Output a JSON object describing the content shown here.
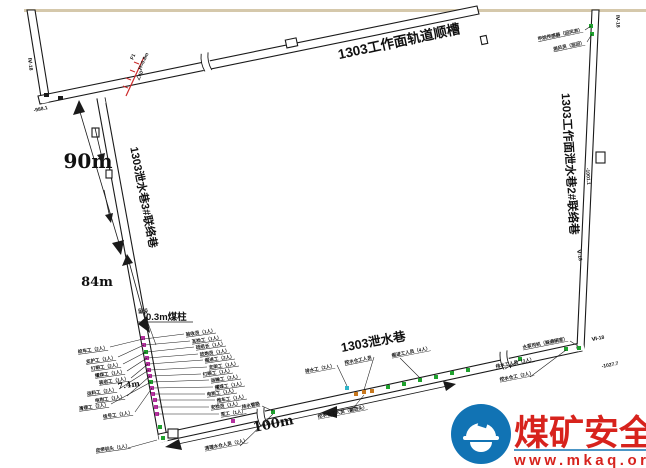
{
  "meta": {
    "bg": "#ffffff",
    "top_border_color": "#d5c8ab"
  },
  "tunnels": {
    "track_gateway": "1303工作面轨道顺槽",
    "left_branch": "1303泄水巷3#联络巷",
    "right_branch": "1303工作面泄水巷2#联络巷",
    "drain_gateway": "1303泄水巷"
  },
  "dimensions": {
    "left_upper": "90m",
    "left_lower": "84m",
    "bottom": "100m",
    "small": "7.4m",
    "pillar_prefix": "留设",
    "pillar": "0.3m煤柱"
  },
  "survey_points": {
    "nw": "Ⅳ-18",
    "nw_elev": "-988.1",
    "ne": "Ⅳ-18",
    "east": "Ⅴ-18",
    "east_elev": "-1001.1",
    "se": "Ⅵ-18",
    "se_elev": "-1027.7"
  },
  "fault": {
    "name": "F1",
    "throw": "H=0.8m",
    "dip": "∠40°",
    "color": "#cc2a2a"
  },
  "workers": {
    "left": [
      "绞车工（2人）",
      "支护工（1人）",
      "打眼工（2人）",
      "攉煤工（1人）",
      "装岩工（1人）",
      "运料工（2人）",
      "电钳工（1人）",
      "清理工（2人）",
      "信号工（1人）"
    ],
    "right": [
      "验收员（1人）",
      "瓦检工（1人）",
      "班组长（1人）",
      "放炮员（1人）",
      "掘进工（2人）",
      "支架工（1人）",
      "打眼工（1人）",
      "运输工（2人）",
      "攉煤工（1人）",
      "电钳工（1人）",
      "推车工（1人）",
      "安检员（1人）",
      "泵工（1人）"
    ],
    "corner_below": [
      "皮带机头（1人）"
    ],
    "bottom_above": [
      "排水工（2人）",
      "挖水仓工人员",
      "掘进工人员（4人）",
      "排水工人员（3人）",
      "水泵司机（躲避硐室）"
    ],
    "bottom_below": [
      "排水管路",
      "清理水仓人员（2人）",
      "挖水仓工人员（掘进头）",
      "挖水仓工（2人）"
    ],
    "top_right": [
      "甲烷传感器（回风流）",
      "测风员（巡回）"
    ]
  },
  "markers": {
    "victim": "#b5309f",
    "survivor": "#1fa12e",
    "pump_team": "#c8781e",
    "sensor": "#2fb4c8"
  },
  "watermark": {
    "site_name": "煤矿安全网",
    "site_url": "www.mkaq.org",
    "text_color": "#d7231d",
    "logo_color": "#1173b4"
  }
}
